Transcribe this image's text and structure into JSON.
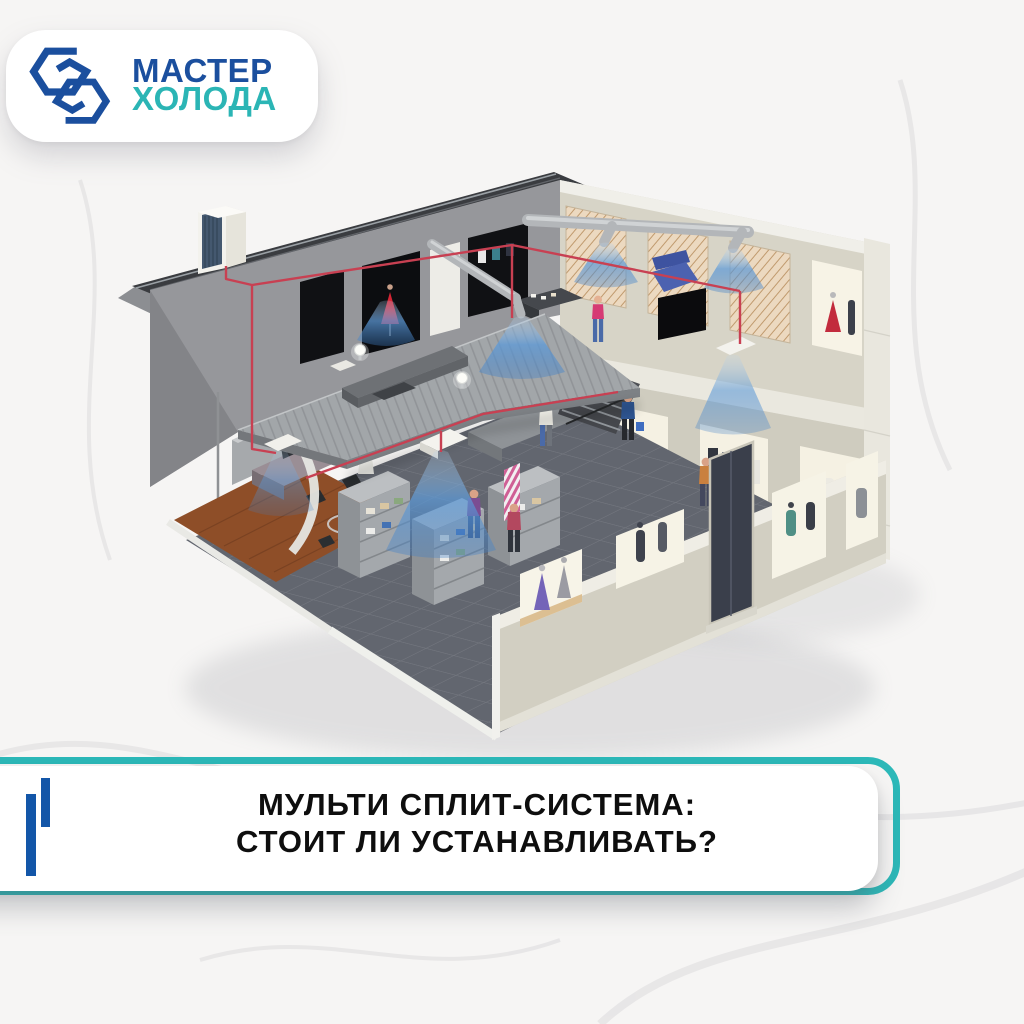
{
  "page": {
    "background_color": "#f6f5f4"
  },
  "logo_badge": {
    "line1": "МАСТЕР",
    "line2": "ХОЛОДА",
    "line1_color": "#1b4f9e",
    "line2_color": "#2bb5b5",
    "icon": "interlocked-hexagons",
    "background": "#ffffff"
  },
  "illustration": {
    "description": "Isometric cutaway of a two-storey clothing store cooled by a multi split air-conditioning system",
    "elements": [
      "outdoor-condenser-on-roof",
      "refrigerant-pipes",
      "ventilation-ducts",
      "ceiling-cassette-units",
      "cool-air-flows",
      "upper-sales-floor",
      "ground-sales-floor",
      "office-area",
      "staircase",
      "display-windows-with-mannequins",
      "shoppers"
    ],
    "airflow_color": "#4f93d6",
    "pipe_color": "#c84052"
  },
  "title_banner": {
    "line1": "МУЛЬТИ СПЛИТ-СИСТЕМА:",
    "line2": "СТОИТ ЛИ УСТАНАВЛИВАТЬ?",
    "text_color": "#0e0e0e",
    "border_color": "#2cb8b8",
    "accent_bars_color": "#1356a8",
    "background": "#ffffff"
  }
}
